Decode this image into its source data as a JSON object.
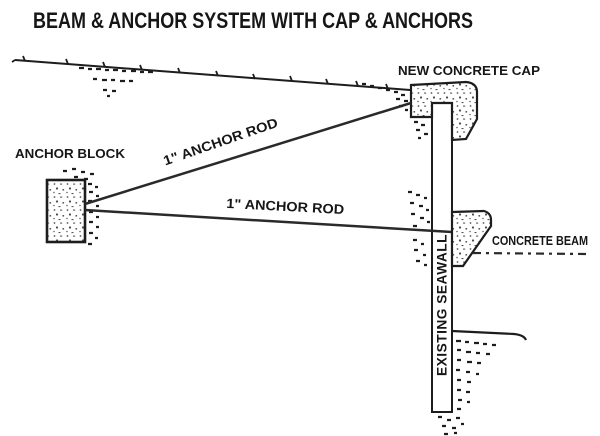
{
  "title": "BEAM & ANCHOR SYSTEM WITH CAP & ANCHORS",
  "labels": {
    "new_concrete_cap": "NEW CONCRETE CAP",
    "anchor_block": "ANCHOR BLOCK",
    "upper_rod": "1\" ANCHOR ROD",
    "lower_rod": "1\" ANCHOR ROD",
    "existing_seawall": "EXISTING SEAWALL",
    "concrete_beam": "CONCRETE BEAM"
  },
  "colors": {
    "ink": "#1d1d1d",
    "background": "#ffffff"
  }
}
